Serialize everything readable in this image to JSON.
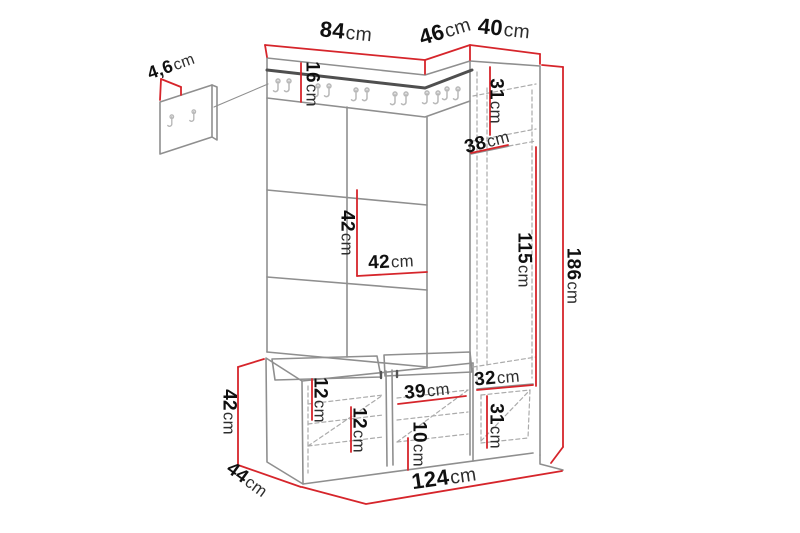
{
  "figure_title": "Hallway furniture dimension diagram",
  "colors": {
    "dimension_line": "#d6252b",
    "outline": "#8f8f8f",
    "dark_edge": "#4f4f4f",
    "dashed_line": "#ababab",
    "hook": "#b8b8b8",
    "background": "#ffffff",
    "text": "#101010"
  },
  "dims": {
    "panel_width": {
      "v": "84",
      "u": "cm"
    },
    "corner_depth": {
      "v": "46",
      "u": "cm"
    },
    "cabinet_width": {
      "v": "40",
      "u": "cm"
    },
    "wall_panel_thickness": {
      "v": "4,6",
      "u": "cm"
    },
    "top_rail_height": {
      "v": "16",
      "u": "cm"
    },
    "cabinet_top_height": {
      "v": "31",
      "u": "cm"
    },
    "cabinet_depth": {
      "v": "38",
      "u": "cm"
    },
    "tile_height": {
      "v": "42",
      "u": "cm"
    },
    "tile_width": {
      "v": "42",
      "u": "cm"
    },
    "cabinet_mid_height": {
      "v": "115",
      "u": "cm"
    },
    "total_height": {
      "v": "186",
      "u": "cm"
    },
    "cabinet_bottom_width": {
      "v": "32",
      "u": "cm"
    },
    "cabinet_bottom_height": {
      "v": "31",
      "u": "cm"
    },
    "bench_gap_top": {
      "v": "12",
      "u": "cm"
    },
    "bench_gap_mid": {
      "v": "12",
      "u": "cm"
    },
    "bench_door_width": {
      "v": "39",
      "u": "cm"
    },
    "bench_gap_bottom": {
      "v": "10",
      "u": "cm"
    },
    "bench_height": {
      "v": "42",
      "u": "cm"
    },
    "bench_depth": {
      "v": "44",
      "u": "cm"
    },
    "total_width": {
      "v": "124",
      "u": "cm"
    }
  }
}
